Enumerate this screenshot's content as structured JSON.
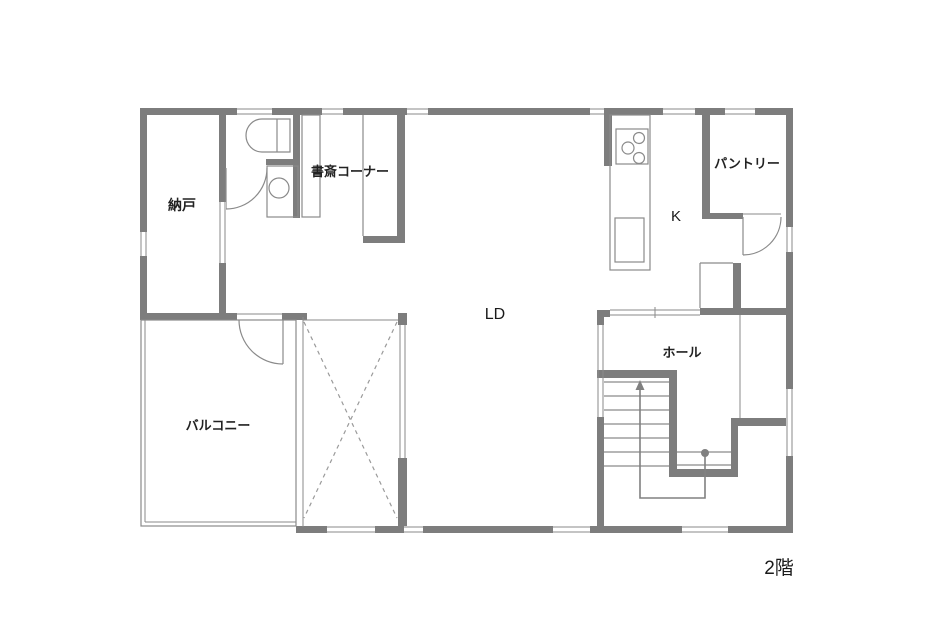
{
  "floor_plan": {
    "floor_label": "2階",
    "rooms": {
      "nando": {
        "label": "納戸"
      },
      "study_corner": {
        "label": "書斎コーナー"
      },
      "living_dining": {
        "label": "LD"
      },
      "kitchen": {
        "label": "K"
      },
      "pantry": {
        "label": "パントリー"
      },
      "hall": {
        "label": "ホール"
      },
      "balcony": {
        "label": "バルコニー"
      }
    },
    "icons": {
      "toilet": "toilet-icon",
      "washbasin": "washbasin-icon",
      "stove": "stove-burner-icon",
      "sink": "kitchen-sink-icon",
      "stair_arrow": "stair-direction-arrow-icon",
      "void_cross": "open-void-x-icon"
    },
    "colors": {
      "wall": "#7d7d7d",
      "thin_line": "#8a8a8a",
      "dashed_line": "#9a9a9a",
      "text": "#222222",
      "background": "#ffffff"
    }
  }
}
